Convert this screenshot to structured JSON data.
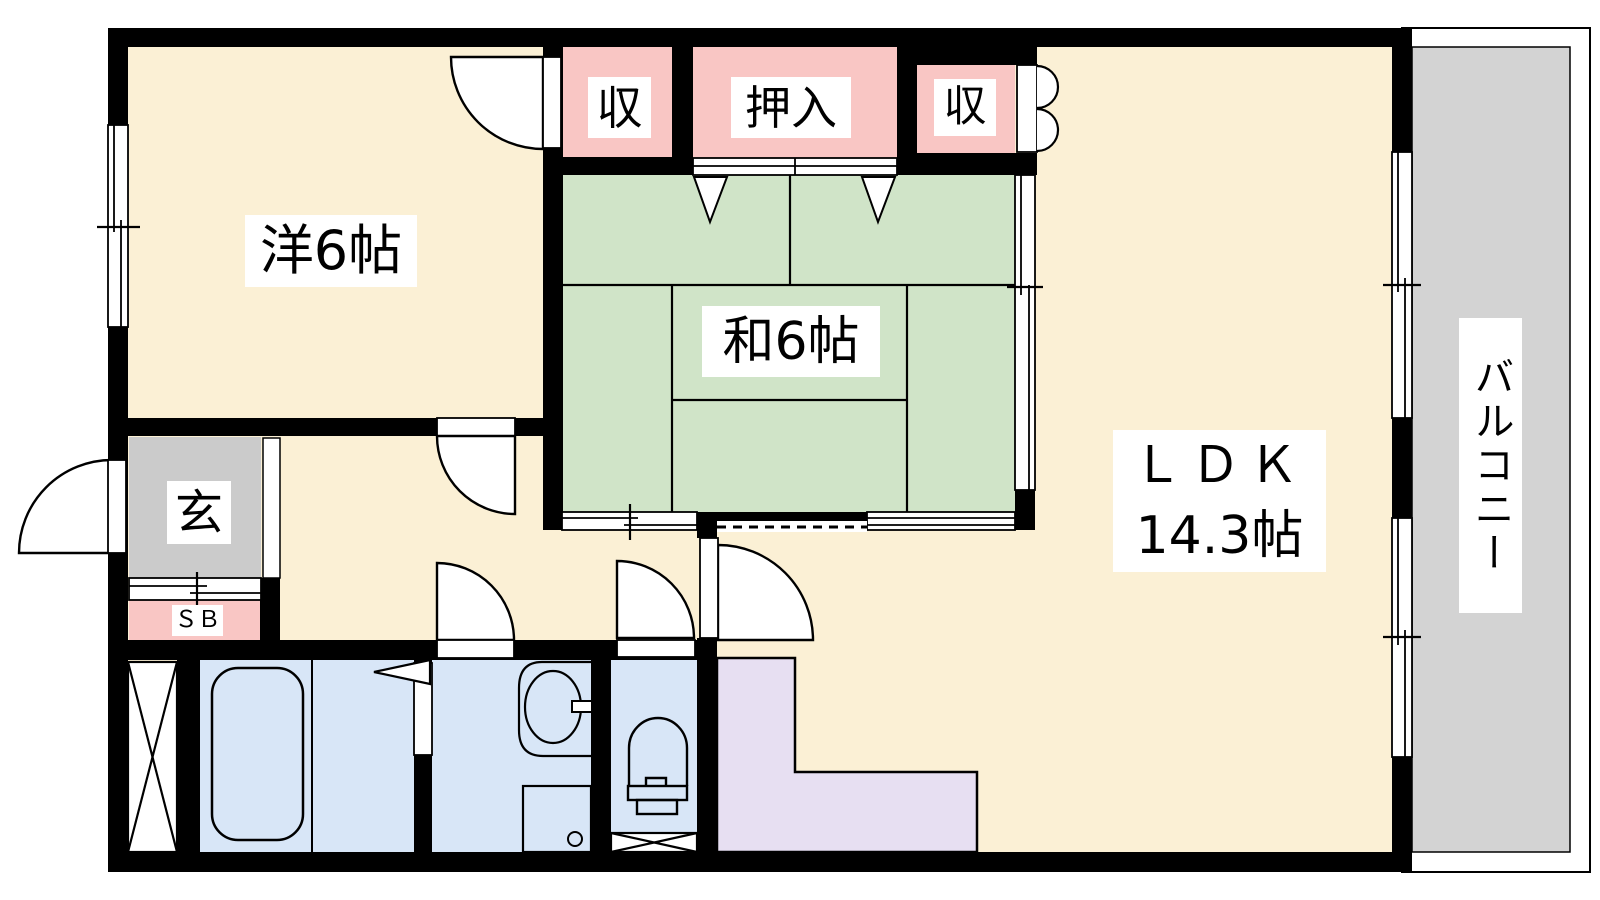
{
  "floorplan": {
    "rooms": {
      "western_room": {
        "label": "洋6帖"
      },
      "japanese_room": {
        "label": "和6帖"
      },
      "ldk": {
        "name": "ＬＤＫ",
        "size": "14.3帖"
      },
      "balcony": {
        "label": "バルコニー"
      },
      "entrance": {
        "label": "玄"
      },
      "shoe_box": {
        "label": "ＳＢ"
      },
      "closet_top_left": {
        "label": "収"
      },
      "oshiire_closet": {
        "label": "押入"
      },
      "closet_top_right": {
        "label": "収"
      }
    },
    "colors": {
      "room_floor": "#FBF0D5",
      "tatami": "#D0E4C8",
      "closet": "#F9C6C4",
      "entrance_floor": "#CBCBCB",
      "balcony_floor": "#D3D3D3",
      "wet_area": "#D8E6F7",
      "kitchen_counter": "#E7DFF2",
      "wall": "#000000"
    }
  }
}
